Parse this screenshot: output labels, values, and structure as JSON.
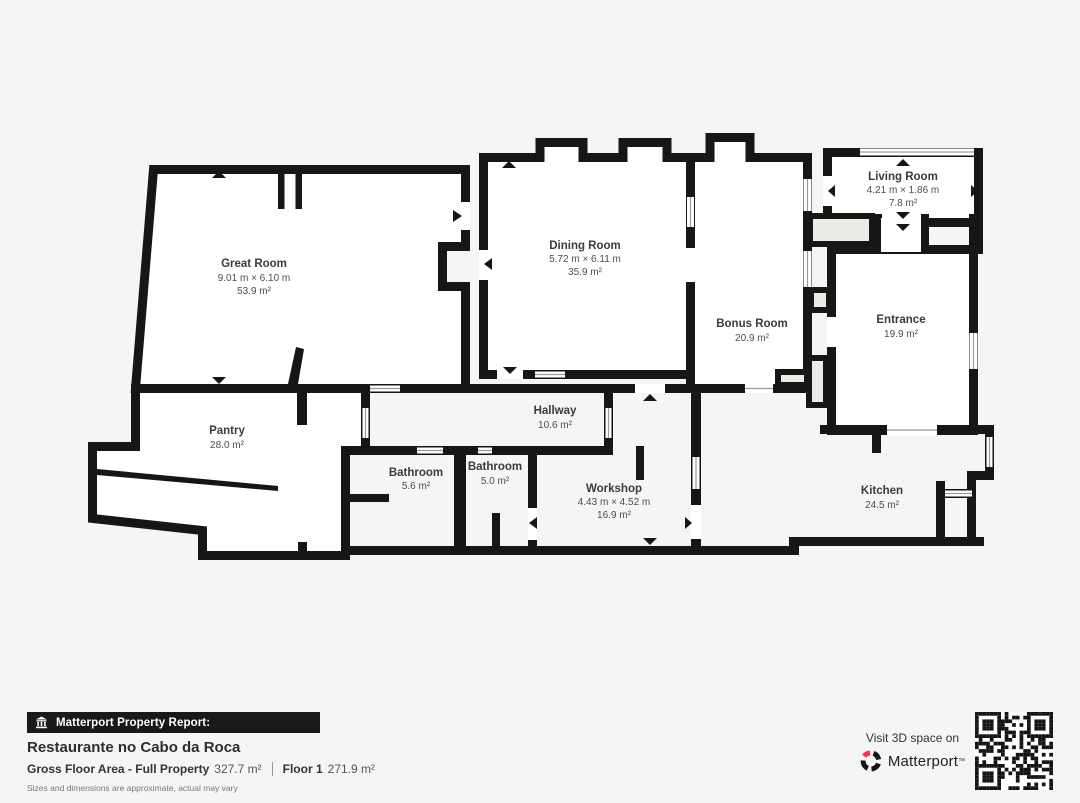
{
  "plan": {
    "rooms": [
      {
        "name": "Great Room",
        "dims": "9.01 m × 6.10 m",
        "area": "53.9 m²"
      },
      {
        "name": "Dining Room",
        "dims": "5.72 m × 6.11 m",
        "area": "35.9 m²"
      },
      {
        "name": "Bonus Room",
        "area": "20.9 m²"
      },
      {
        "name": "Living Room",
        "dims": "4.21 m × 1.86 m",
        "area": "7.8 m²"
      },
      {
        "name": "Entrance",
        "area": "19.9 m²"
      },
      {
        "name": "Pantry",
        "area": "28.0 m²"
      },
      {
        "name": "Hallway",
        "area": "10.6 m²"
      },
      {
        "name": "Bathroom",
        "area": "5.6 m²"
      },
      {
        "name": "Bathroom",
        "area": "5.0 m²"
      },
      {
        "name": "Workshop",
        "dims": "4.43 m × 4.52 m",
        "area": "16.9 m²"
      },
      {
        "name": "Kitchen",
        "area": "24.5 m²"
      }
    ],
    "colors": {
      "wall": "#161616",
      "room": "#ffffff",
      "background": "#f5f5f3",
      "niche": "#ecebe8"
    }
  },
  "footer": {
    "bar_label": "Matterport Property Report:",
    "title": "Restaurante no Cabo da Roca",
    "gfa_label": "Gross Floor Area - Full Property",
    "gfa_value": "327.7 m²",
    "floor_label": "Floor 1",
    "floor_value": "271.9 m²",
    "disclaimer": "Sizes and dimensions are approximate, actual may vary",
    "visit_label": "Visit 3D space on",
    "brand": "Matterport",
    "brand_mark": "™",
    "brand_red": "#ff3158"
  }
}
